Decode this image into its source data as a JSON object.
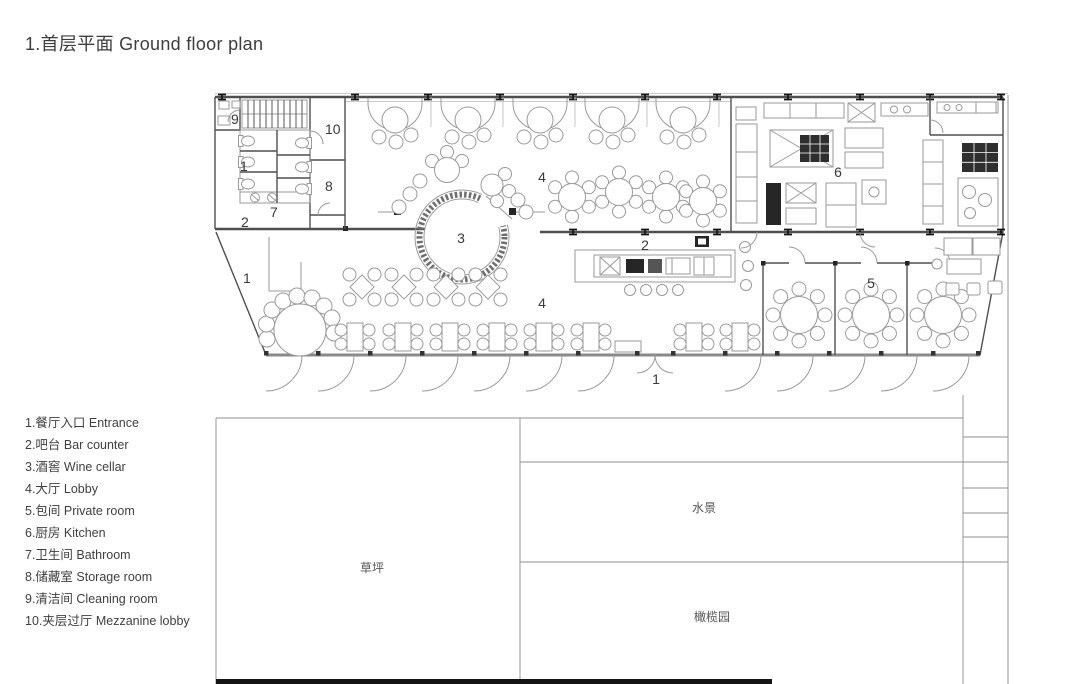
{
  "title": "1.首层平面 Ground floor plan",
  "legend": {
    "items": [
      "1.餐厅入口 Entrance",
      "2.吧台 Bar counter",
      "3.酒窖 Wine cellar",
      "4.大厅 Lobby",
      "5.包间 Private room",
      "6.厨房 Kitchen",
      "7.卫生间 Bathroom",
      "8.储藏室 Storage room",
      "9.清洁间 Cleaning room",
      "10.夹层过厅 Mezzanine lobby"
    ]
  },
  "site_labels": {
    "lawn": "草坪",
    "water": "水景",
    "olive": "橄榄园"
  },
  "plan_markers": {
    "room9": "9",
    "room10": "10",
    "side1": "1",
    "room8": "8",
    "room7": "7",
    "bar2a": "2",
    "left1": "1",
    "cellar3": "3",
    "lobby4a": "4",
    "bar2b": "2",
    "kitchen6": "6",
    "private5": "5",
    "lobby4b": "4",
    "main1": "1"
  },
  "colors": {
    "wall": "#4f4f4f",
    "furniture": "#9a9a9a",
    "dark_fill": "#262626",
    "text": "#3c3c3c",
    "site_line": "#8f8f8f"
  }
}
